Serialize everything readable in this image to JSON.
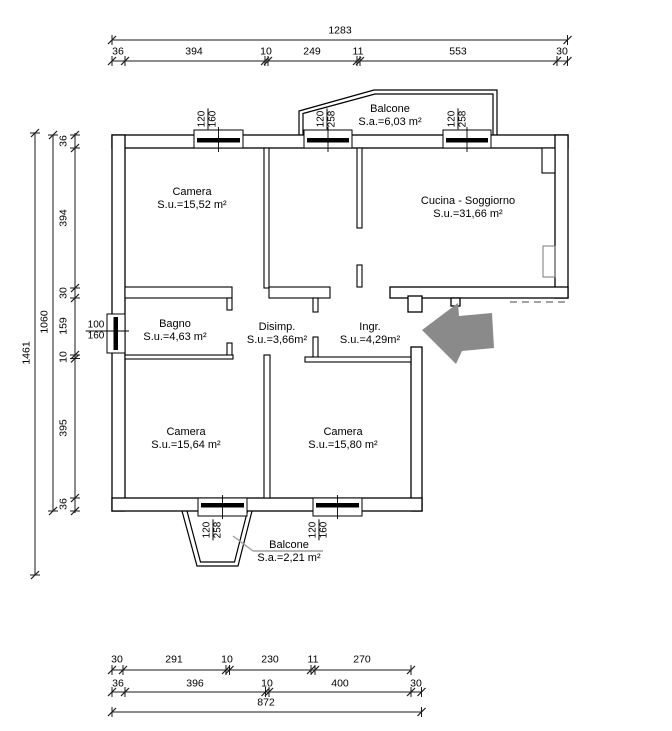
{
  "rooms": {
    "camera_tl": {
      "name": "Camera",
      "area": "S.u.=15,52 m²"
    },
    "cucina_soggiorno": {
      "name": "Cucina - Soggiorno",
      "area": "S.u.=31,66 m²"
    },
    "bagno": {
      "name": "Bagno",
      "area": "S.u.=4,63 m²"
    },
    "disimpegno": {
      "name": "Disimp.",
      "area": "S.u.=3,66m²"
    },
    "ingresso": {
      "name": "Ingr.",
      "area": "S.u.=4,29m²"
    },
    "camera_bl": {
      "name": "Camera",
      "area": "S.u.=15,64 m²"
    },
    "camera_br": {
      "name": "Camera",
      "area": "S.u.=15,80 m²"
    },
    "balcone_nord": {
      "name": "Balcone",
      "area": "S.a.=6,03 m²"
    },
    "balcone_sud": {
      "name": "Balcone",
      "area": "S.a.=2,21 m²"
    }
  },
  "windows": {
    "camera_tl_top": {
      "width": "120",
      "height": "160"
    },
    "corridoio_top": {
      "width": "120",
      "height": "258"
    },
    "cucina_top": {
      "width": "120",
      "height": "258"
    },
    "bagno_left": {
      "width": "100",
      "height": "160"
    },
    "camera_bl_bottom": {
      "width": "120",
      "height": "258"
    },
    "camera_br_bottom": {
      "width": "120",
      "height": "160"
    }
  },
  "dimensions": {
    "top": {
      "total": "1283",
      "chain": [
        "36",
        "394",
        "10",
        "249",
        "11",
        "553",
        "30"
      ]
    },
    "left": {
      "overall": "1461",
      "body": "1060",
      "chain": [
        "36",
        "394",
        "30",
        "159",
        "10",
        "395",
        "36"
      ]
    },
    "bottom": {
      "chain_upper": [
        "30",
        "291",
        "10",
        "230",
        "11",
        "270"
      ],
      "chain_lower": [
        "36",
        "396",
        "10",
        "400",
        "30"
      ],
      "total": "872"
    }
  },
  "colors": {
    "line": "#000000",
    "arrow": "#8a8a8a",
    "leader": "#9e9e9e"
  }
}
